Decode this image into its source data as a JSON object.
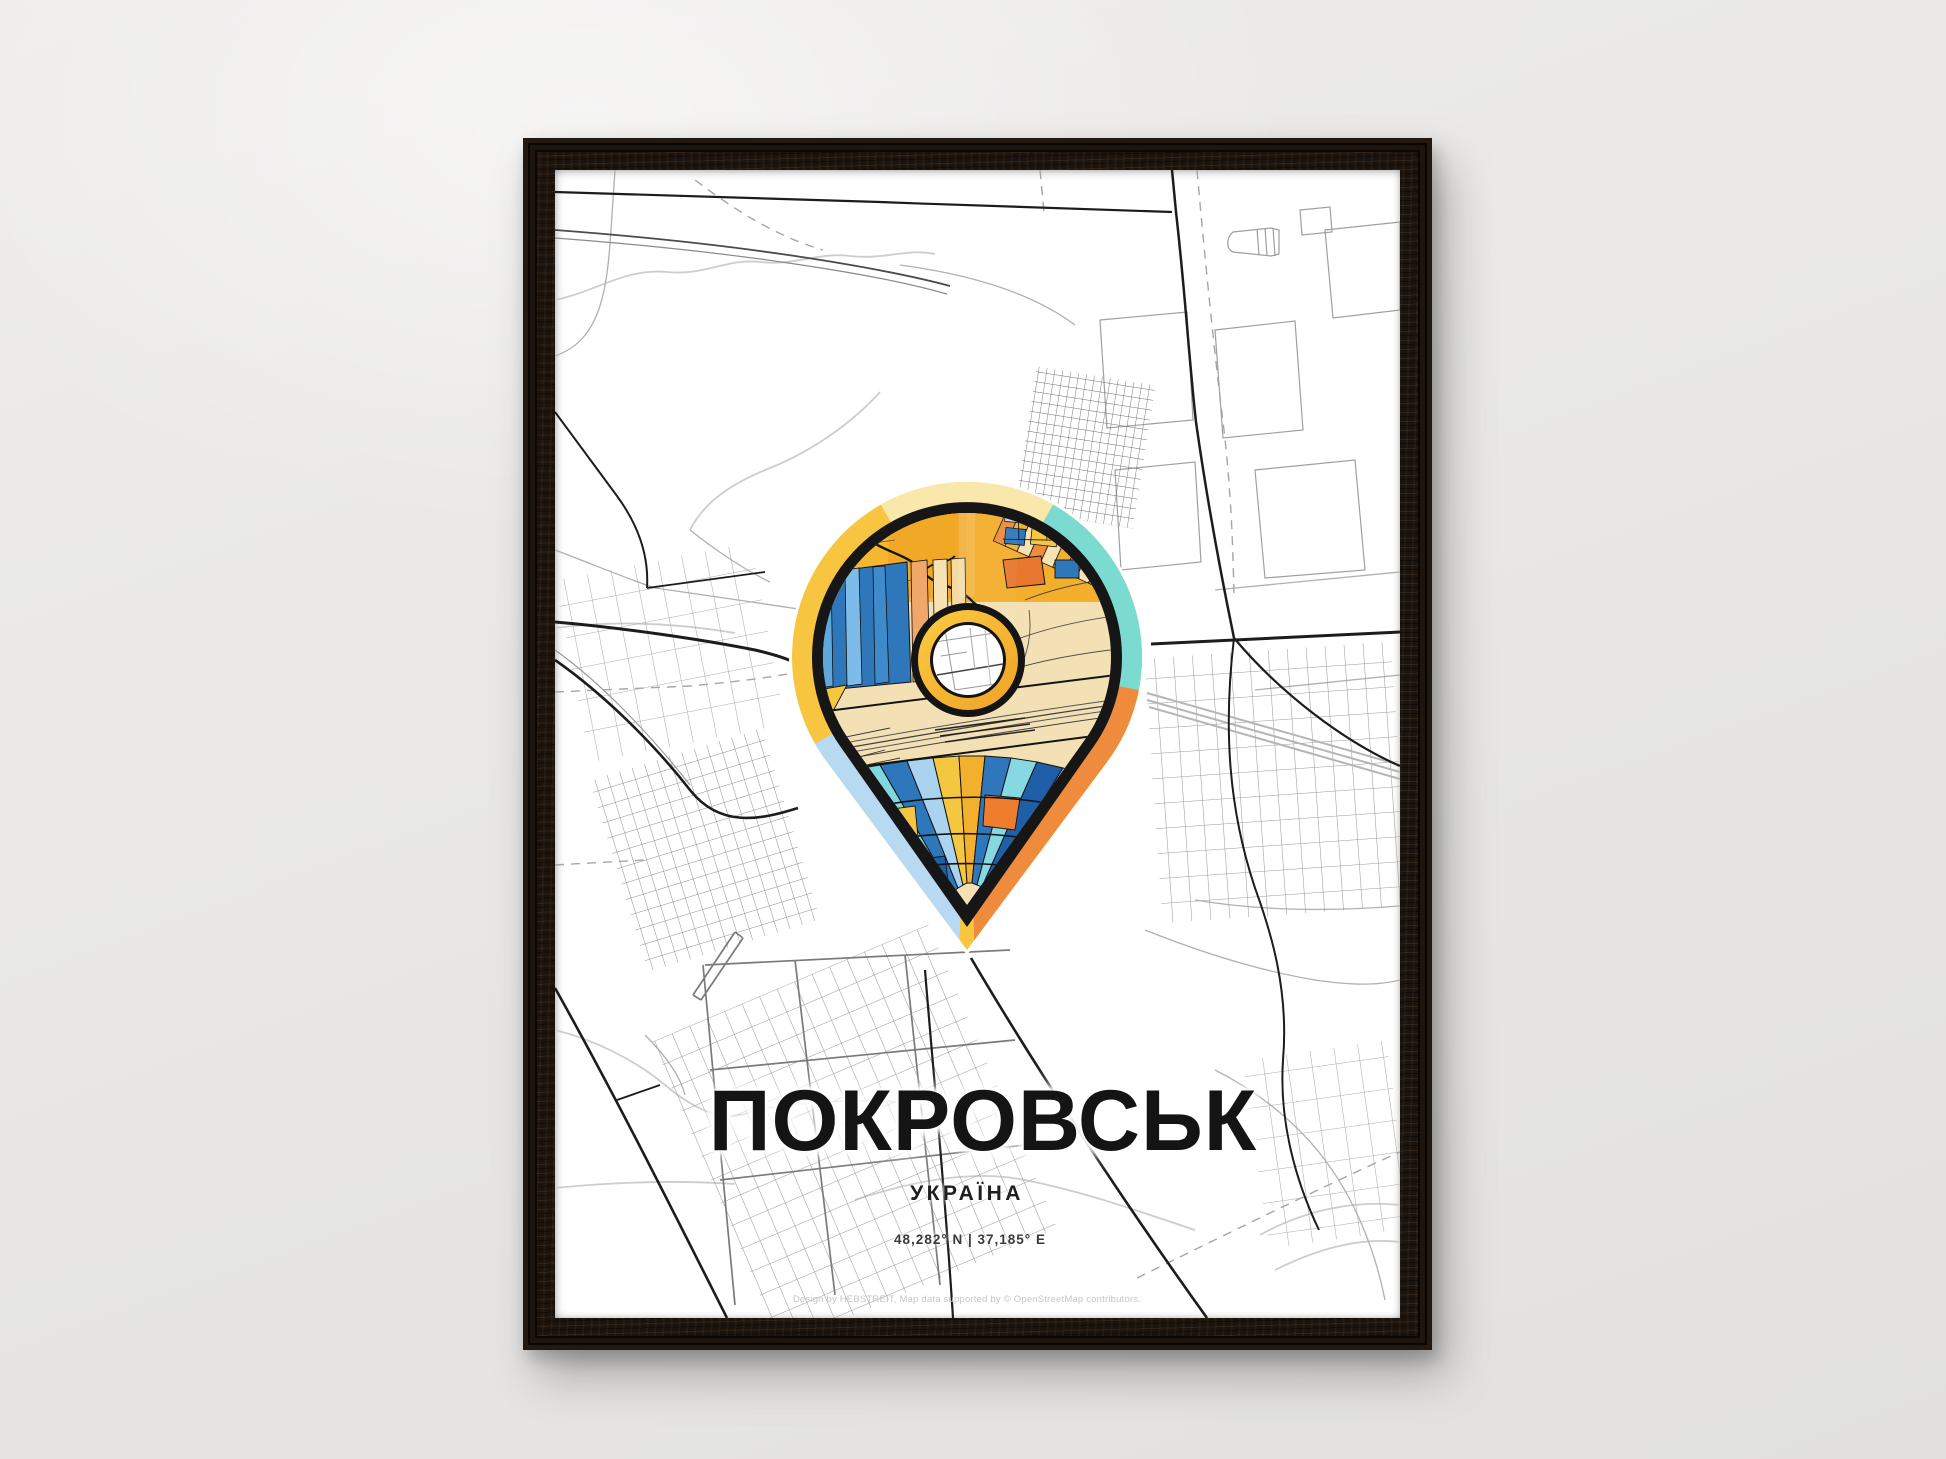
{
  "scene": {
    "description": "Black wood framed minimal city map poster hanging on a light gray wall",
    "wall_color": "#e9e8e6",
    "frame_color": "#1b130c"
  },
  "poster": {
    "title": "ПОКРОВСЬК",
    "country": "УКРАЇНА",
    "coordinates": "48,282° N | 37,185° E",
    "credit": "Design by HEBSTREIT, Map data supported by © OpenStreetMap contributors.",
    "pin": {
      "style": "location-pin filled with colorful city block mosaic and golden center ring",
      "border_colors": [
        "#F7C53F",
        "#FAE7AC",
        "#7BDBD1",
        "#EF8B3C",
        "#B7D9F1"
      ],
      "ring_color": "#F2A72E",
      "outline_color": "#141414",
      "mosaic_colors": [
        "#F3AE2B",
        "#2E77BB",
        "#5FA8DB",
        "#A9D3EE",
        "#7FD8E0",
        "#8FE3D5",
        "#F5C63F",
        "#F4E0B5",
        "#EE7E2E",
        "#1F5FA8",
        "#F0A86A"
      ]
    },
    "map_colors": {
      "background": "#ffffff",
      "streets_light": "#c9c9c9",
      "streets_medium": "#9a9a9a",
      "streets_dark": "#1e1e1e"
    }
  }
}
